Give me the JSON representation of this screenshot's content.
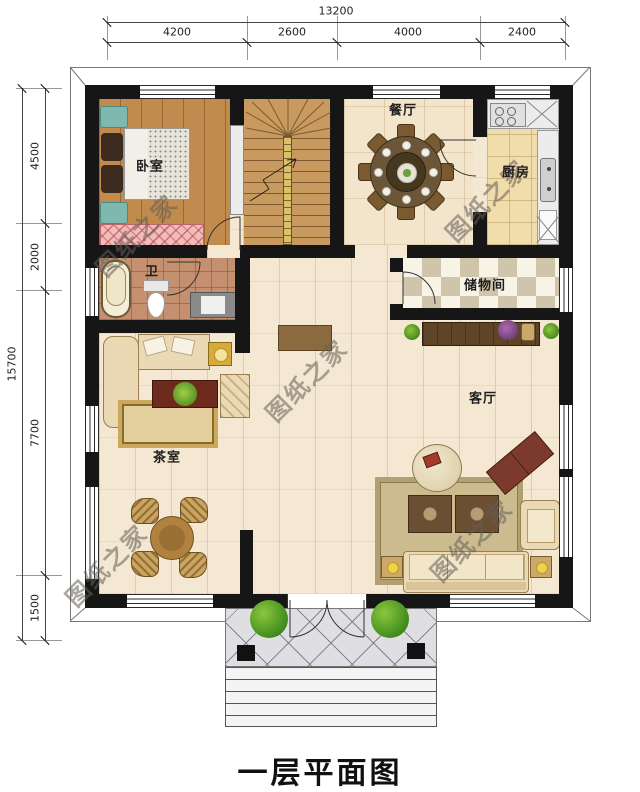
{
  "title": "一层平面图",
  "watermark_text": "图纸之家",
  "dimensions": {
    "top_total": "13200",
    "top_segments": [
      "4200",
      "2600",
      "4000",
      "2400"
    ],
    "left_total": "15700",
    "left_segments": [
      "4500",
      "2000",
      "7700",
      "1500"
    ]
  },
  "rooms": {
    "bedroom": "卧室",
    "dining": "餐厅",
    "kitchen": "厨房",
    "bath": "卫",
    "storage": "储物间",
    "living": "客厅",
    "tea": "茶室"
  },
  "colors": {
    "wall": "#161616",
    "floor_light": "#f5e8d2",
    "floor_bedroom": "#c28b4e",
    "bush_green": "#4e9a24",
    "watermark_gray": "#645f58"
  }
}
